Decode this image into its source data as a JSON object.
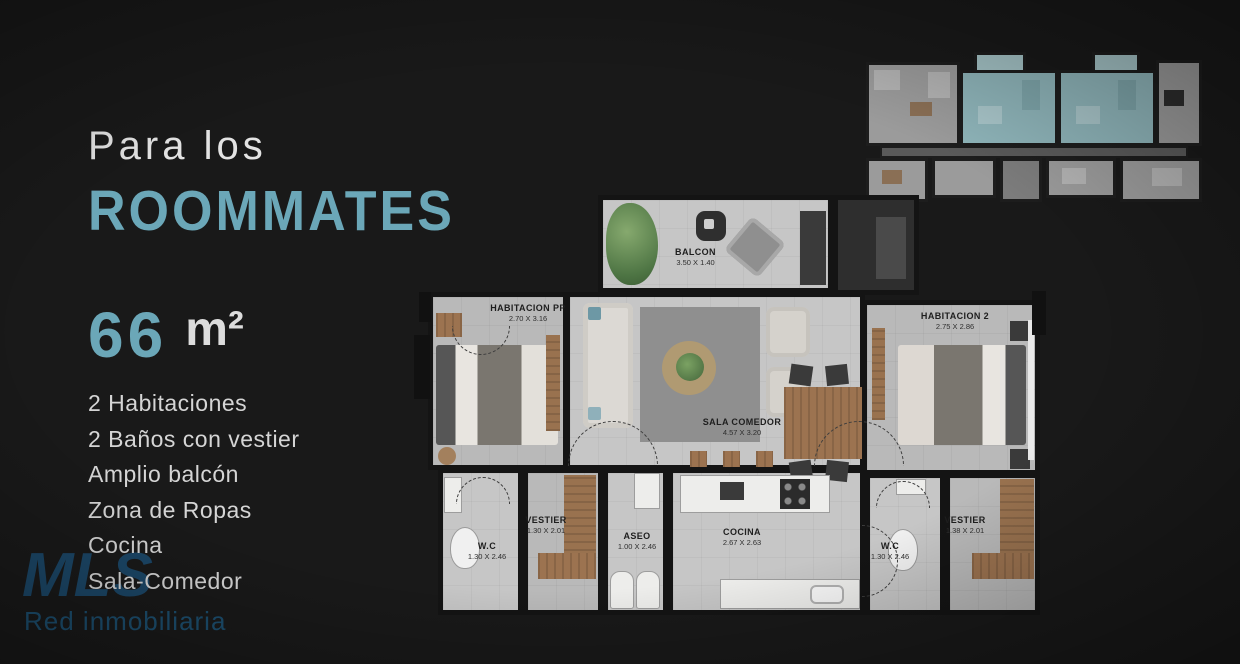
{
  "page": {
    "background": "#191919",
    "accent": "#6BA7B8"
  },
  "left_panel": {
    "subtitle": "Para los",
    "title": "ROOMMATES",
    "area_value": "66",
    "area_unit": "m²",
    "features": [
      "2 Habitaciones",
      "2 Baños con vestier",
      "Amplio balcón",
      "Zona de Ropas",
      "Cocina",
      "Sala-Comedor"
    ]
  },
  "logo": {
    "brand": "MLS",
    "tagline": "Red inmobiliaria",
    "color": "#1C4A6D"
  },
  "floor_plan": {
    "rooms": {
      "balcon": {
        "name": "BALCON",
        "dims": "3.50 X 1.40"
      },
      "habitacion_pp": {
        "name": "HABITACION PP",
        "dims": "2.70 X 3.16"
      },
      "sala_comedor": {
        "name": "SALA COMEDOR",
        "dims": "4.57 X 3.20"
      },
      "habitacion_2": {
        "name": "HABITACION 2",
        "dims": "2.75 X 2.86"
      },
      "wc_izquierdo": {
        "name": "W.C",
        "dims": "1.30 X 2.46"
      },
      "vestier_izq": {
        "name": "VESTIER",
        "dims": "1.30 X 2.01"
      },
      "aseo": {
        "name": "ASEO",
        "dims": "1.00 X 2.46"
      },
      "cocina": {
        "name": "COCINA",
        "dims": "2.67 X 2.63"
      },
      "wc_derecho": {
        "name": "W.C",
        "dims": "1.30 X 2.46"
      },
      "vestier_der": {
        "name": "VESTIER",
        "dims": "1.38 X 2.01"
      }
    }
  },
  "building_plan": {
    "highlight_color": "#8FB5BA"
  }
}
